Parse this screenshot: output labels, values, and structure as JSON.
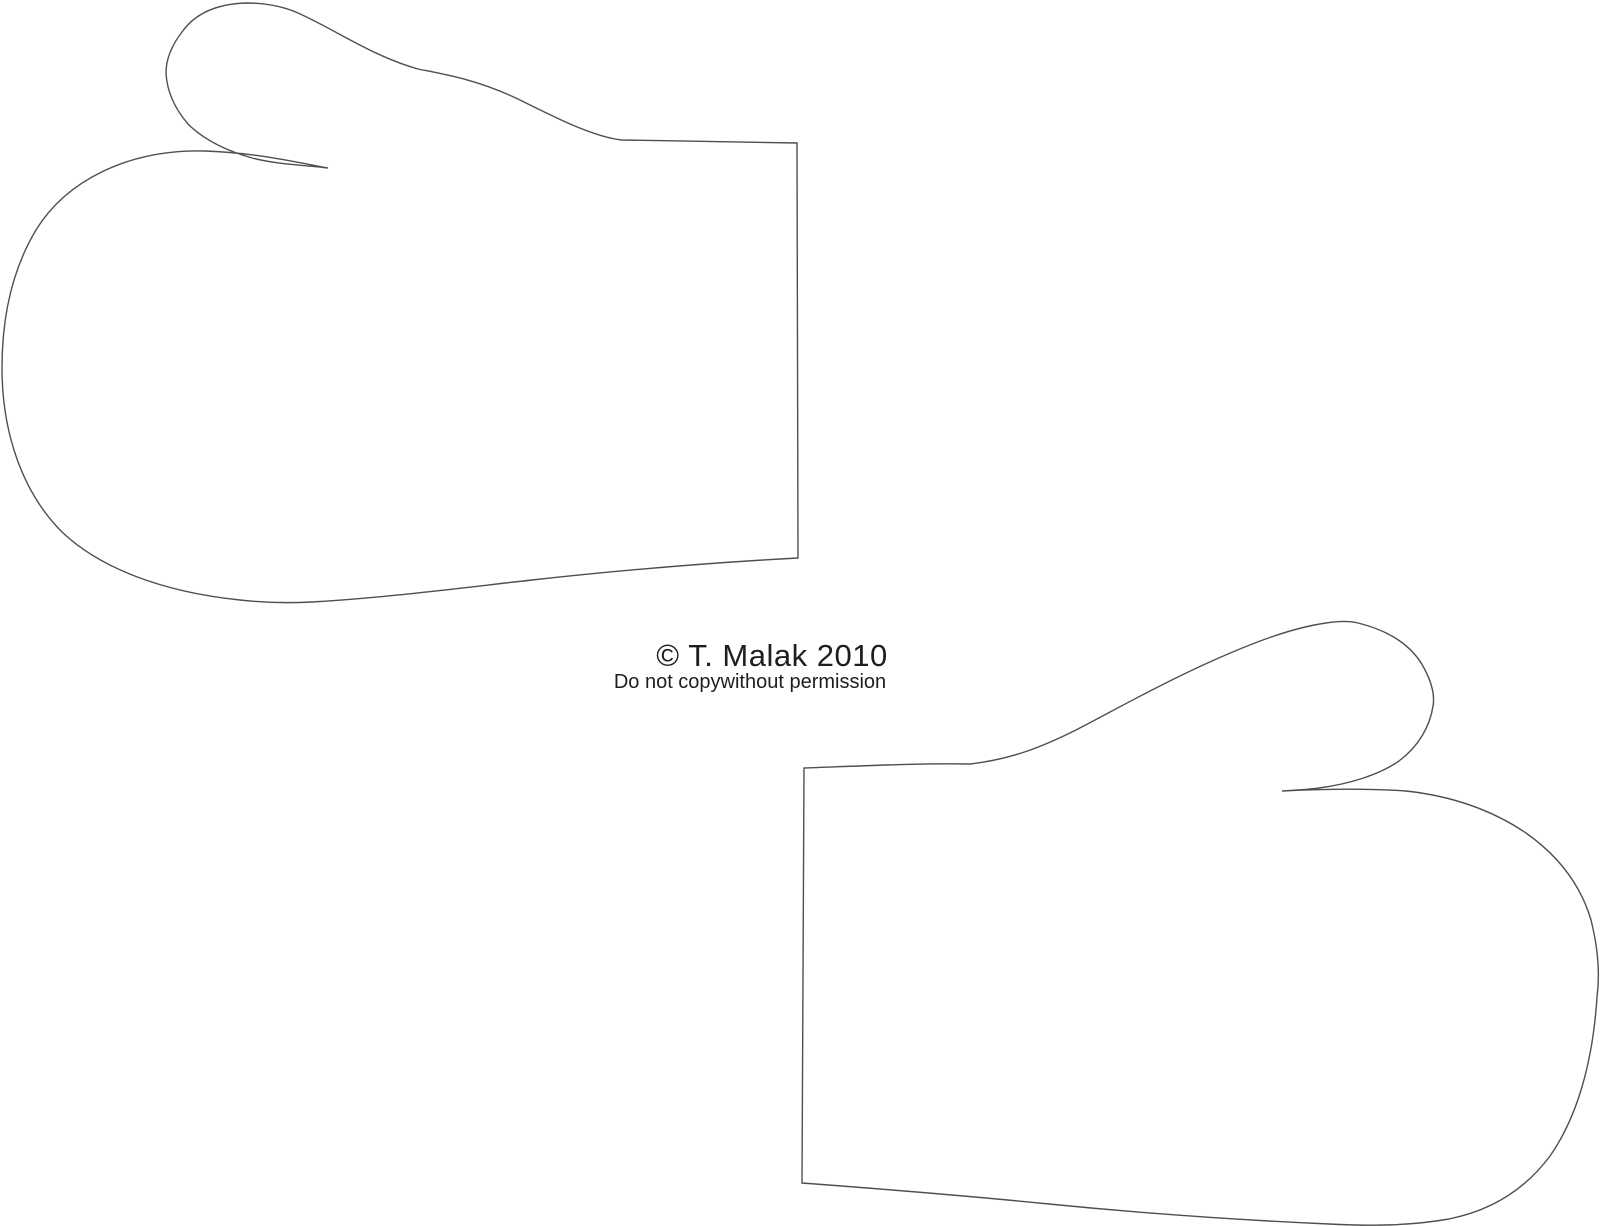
{
  "page": {
    "background": "#ffffff",
    "width": 1600,
    "height": 1226
  },
  "watermark": {
    "line1": "© T. Malak 2010",
    "line2": "Do not copywithout permission",
    "text_color": "#1e1e1e"
  },
  "template": {
    "line_color": "#4f4f4f",
    "shape_count": "2",
    "shapes": [
      {
        "label": "top-left-mitten-outline"
      },
      {
        "label": "bottom-right-mitten-outline"
      }
    ]
  }
}
